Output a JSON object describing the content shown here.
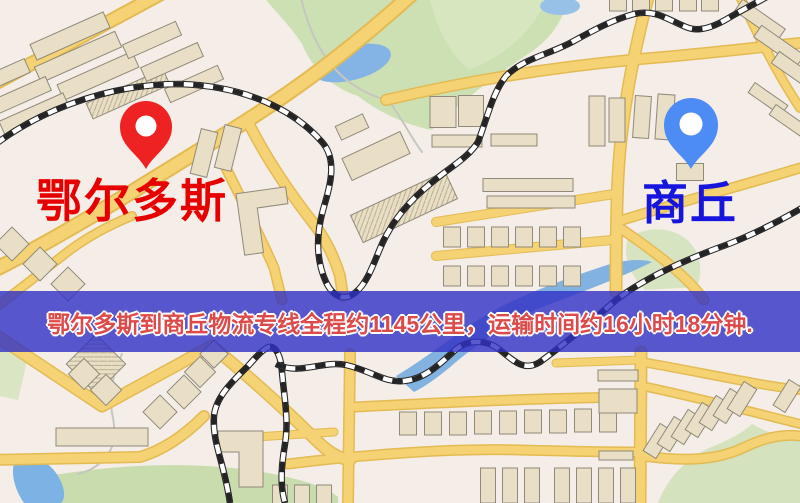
{
  "map": {
    "origin": {
      "name": "鄂尔多斯",
      "pin_color": "#ee2222",
      "label_color": "#e60000"
    },
    "destination": {
      "name": "商丘",
      "pin_color": "#4d8cf5",
      "label_color": "#1515dd"
    },
    "banner": {
      "text": "鄂尔多斯到商丘物流专线全程约1145公里，运输时间约16小时18分钟.",
      "distance_km": "1145",
      "duration": "16小时18分钟",
      "background": "rgba(48,48,196,0.80)",
      "text_color": "#dc4a4a"
    },
    "colors": {
      "base": "#f3ece6",
      "road_core": "#f5d273",
      "road_casing": "#e3bb52",
      "park": "#cde0b4",
      "water": "#82b2e0",
      "building": "#e9dfc6",
      "railway": "#242424"
    }
  }
}
